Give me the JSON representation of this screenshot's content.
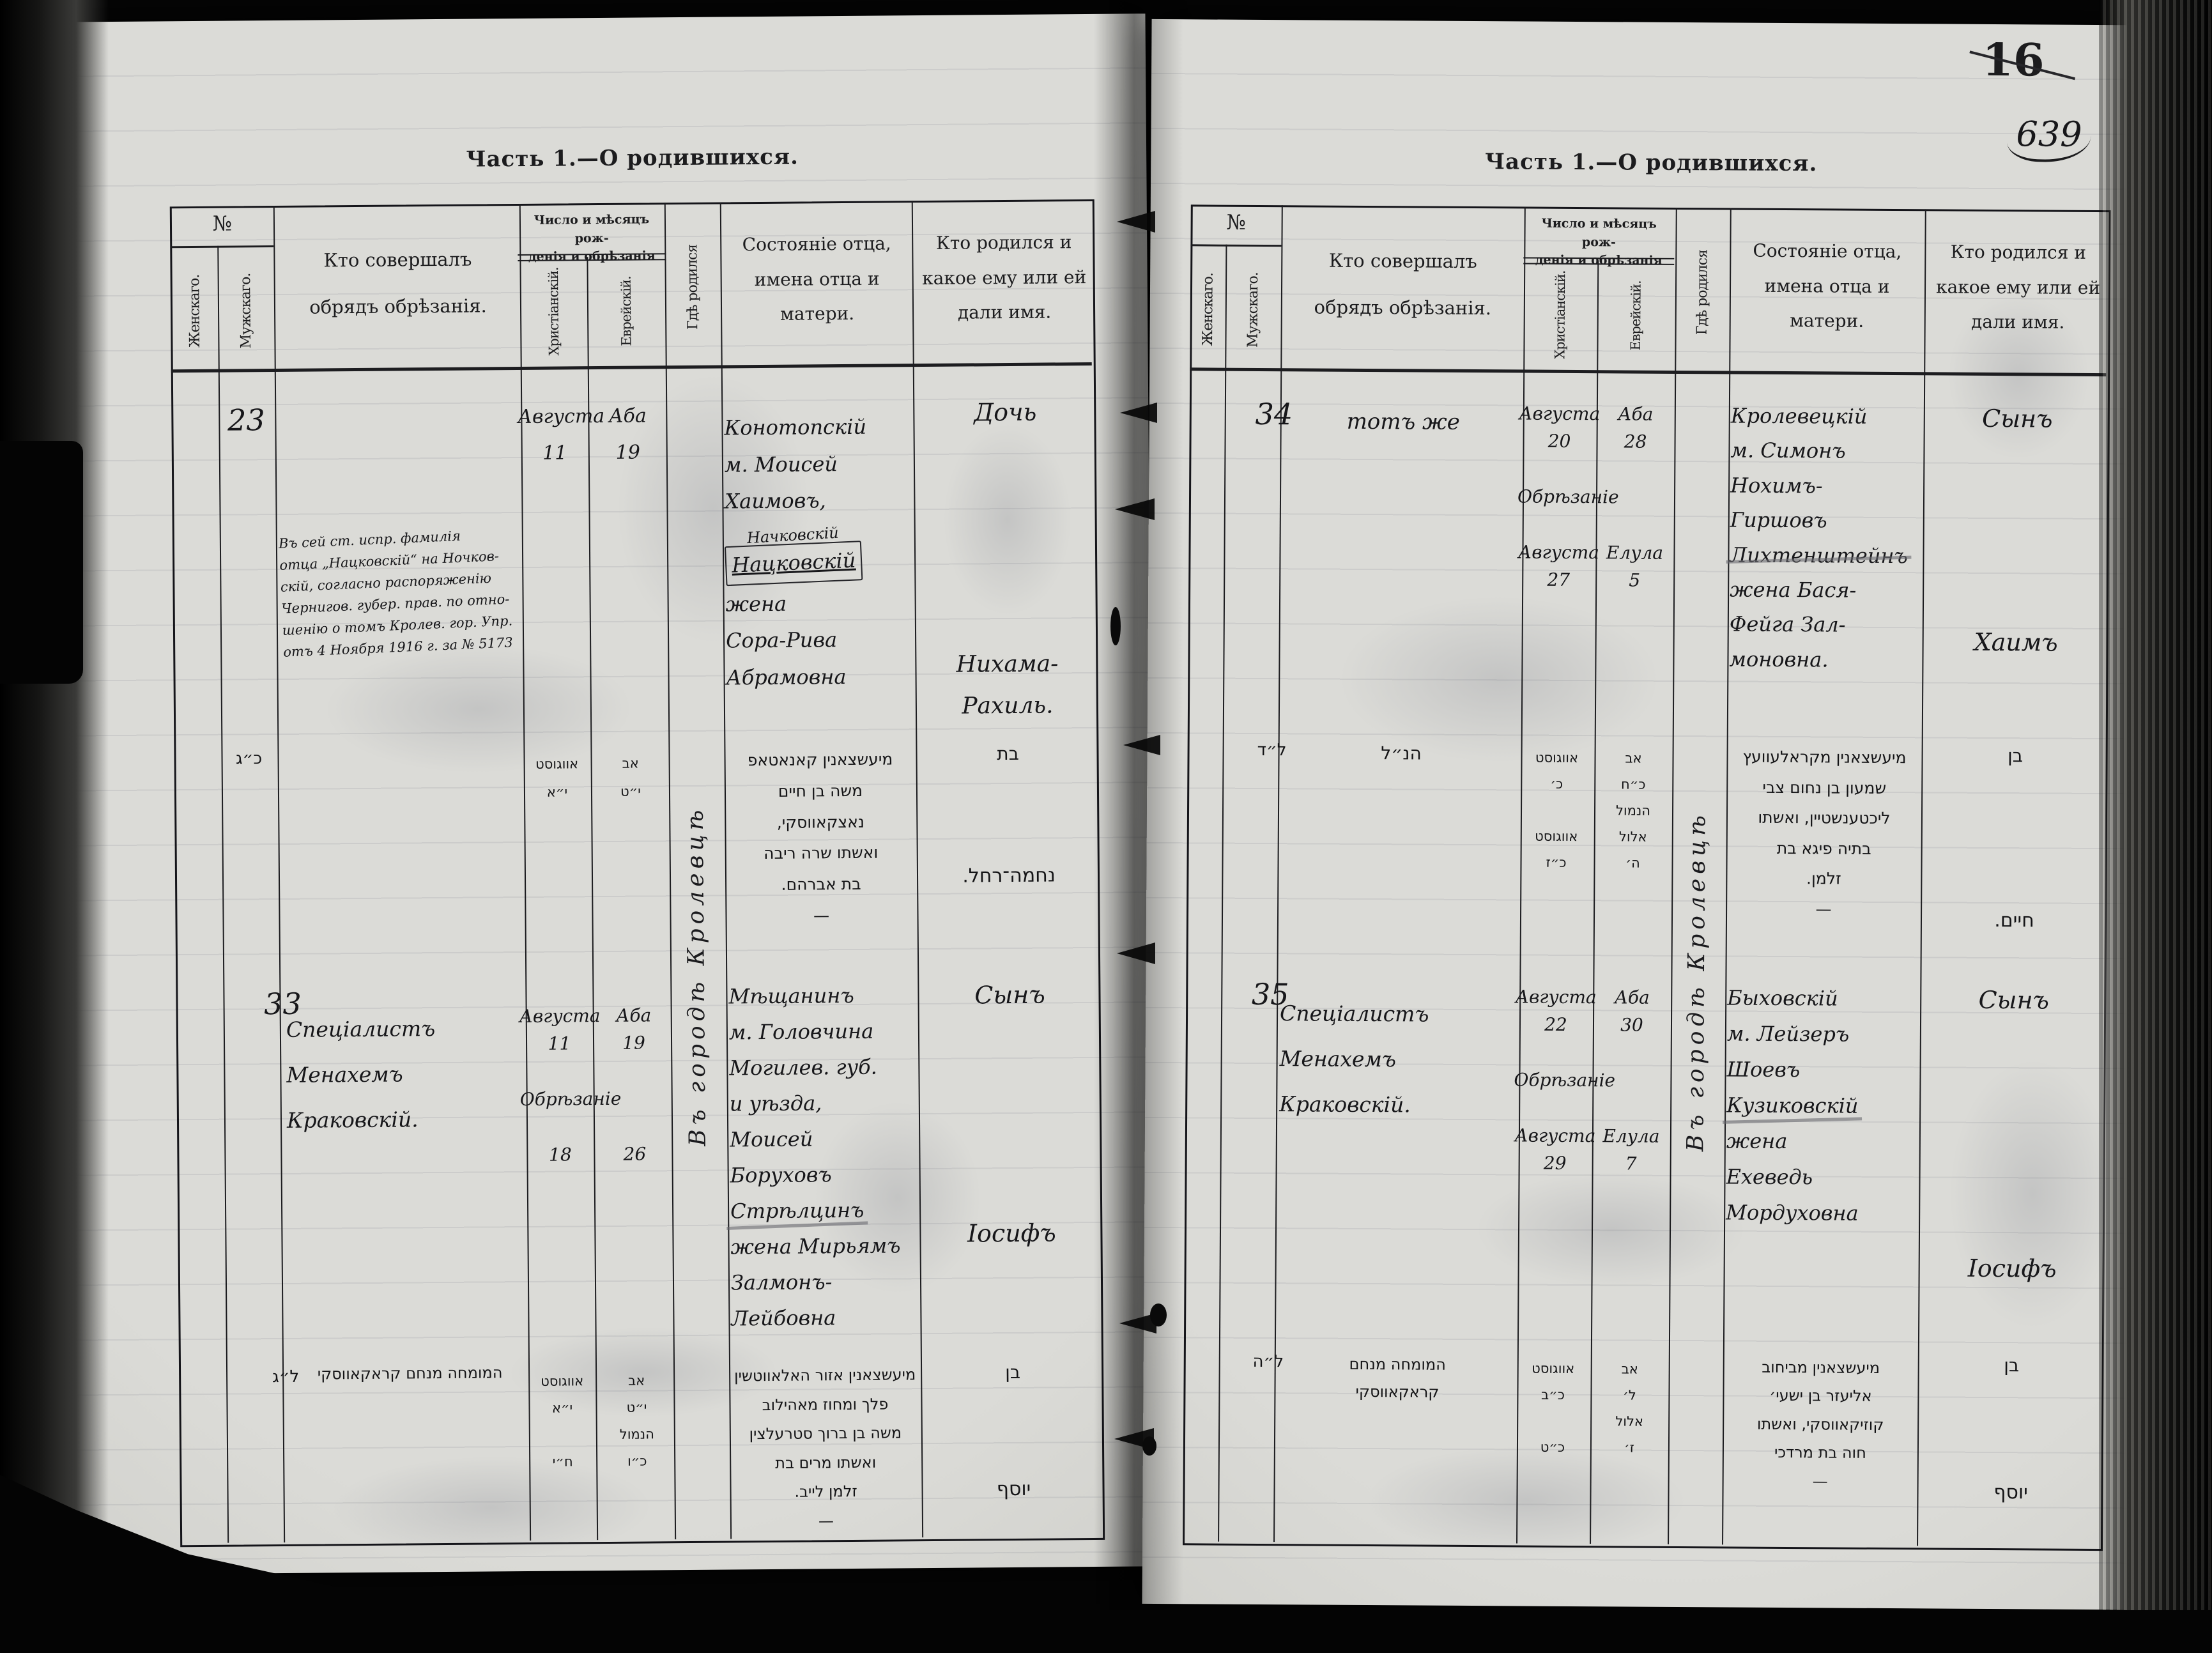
{
  "corner": {
    "printed_folio": "16",
    "handwritten_folio": "639"
  },
  "form": {
    "title": "Часть 1.—О родившихся.",
    "no": "№",
    "female": "Женскаго.",
    "male": "Мужскаго.",
    "officiant": "Кто совершалъ\nобрядъ обрѣзанія.",
    "dates": "Число и мѣсяцъ рож-\nденія и обрѣзанія",
    "christian": "Христіанскій.",
    "jewish": "Еврейскій.",
    "birthplace": "Гдѣ родился",
    "father": "Состояніе отца,\nимена отца и\nматери.",
    "child": "Кто родился и\nкакое ему или ей\nдали имя."
  },
  "left_page": {
    "birthplace_entry": "Въ городѣ Кролевцѣ",
    "record_23": {
      "number": "23",
      "annotation": "Въ сей ст. испр. фамилія\nотца „Нацковскій“ на Ночков-\nскій, согласно распоряженію\nЧернигов. губер. прав. по отно-\nшенію о томъ Кролев. гор. Упр.\nотъ 4 Ноября 1916 г. за № 5173",
      "date_christian": "Августа\n11",
      "date_jewish": "Аба\n19",
      "father_1": "Конотопскій\nм. Моисей\nХаимовъ,",
      "father_inserted": "Начковскій",
      "father_boxed": "Нацковскій",
      "father_2": "жена\nСора-Рива\nАбрамовна",
      "child_type": "Дочь",
      "child_name": "Нихама-\nРахиль."
    },
    "record_23_heb": {
      "number": "כ״ג",
      "date_christian": "אווגוסט\nי״א",
      "date_jewish": "אב\nי״ט",
      "father": "מיעשצאנין קאנאטאפ\nמשה בן חיים\nנאצקאווסקי,\nואשתו שרה ריבה\nבת אברהם.\n—",
      "child_type": "בת",
      "child_name": "נחמה־רחל."
    },
    "record_33": {
      "number": "33",
      "officiant": "Спеціалистъ\nМенахемъ\nКраковскій.",
      "date_christian": "Августа\n11\n\nОбрѣзаніе\n\n18",
      "date_jewish": "Аба\n19\n\n\n\n26",
      "father_1": "Мѣщанинъ\nм. Головчина\nМогилев. губ.\nи уѣзда,\nМоисей\nБоруховъ",
      "father_struck": "Стрѣлцинъ",
      "father_2": "жена Мирьямъ\nЗалмонъ-\nЛейбовна",
      "child_type": "Сынъ",
      "child_name": "Іосифъ"
    },
    "record_33_heb": {
      "number": "ל״ג",
      "officiant": "המומחה מנחם קראקאווסקי",
      "date_christian": "אווגוסט\nי״א\n\nח״י",
      "date_jewish": "אב\nי״ט\nהנמול\nכ״ו",
      "father": "מיעשצאנין אזור האלאווטשין\nפלך ומחוז מאהילוב\nמשה בן ברוך סטרעלצין\nואשתו מרים בת\nזלמן לייב.\n—",
      "child_type": "בן",
      "child_name": "יוסף"
    }
  },
  "right_page": {
    "birthplace_entry": "Въ городѣ Кролевцѣ",
    "record_34": {
      "number": "34",
      "officiant": "тотъ же",
      "date_christian": "Августа\n20\n\nОбрѣзаніе\n\nАвгуста\n27",
      "date_jewish": "Аба\n28\n\n\n\nЕлула\n5",
      "father_1": "Кролевецкій\nм. Симонъ\nНохимъ-\nГиршовъ",
      "father_struck": "Лихтенштейнъ",
      "father_2": "жена Бася-\nФейга Зал-\nмоновна.",
      "child_type": "Сынъ",
      "child_name": "Хаимъ"
    },
    "record_34_heb": {
      "number": "ל״ד",
      "officiant": "הנ״ל",
      "date_christian": "אווגוסט\nכ׳\n\nאווגוסט\nכ״ז",
      "date_jewish": "אב\nכ״ח\nהנמול\nאלול\nה׳",
      "father": "מיעשצאנין מקראלעוועץ\nשמעון בן נחום צבי\nליכטענשטיין, ואשתו\nבתיה פיגא בת\nזלמן.\n—",
      "child_type": "בן",
      "child_name": "חיים."
    },
    "record_35": {
      "number": "35",
      "officiant": "Спеціалистъ\nМенахемъ\nКраковскій.",
      "date_christian": "Августа\n22\n\nОбрѣзаніе\n\nАвгуста\n29",
      "date_jewish": "Аба\n30\n\n\n\nЕлула\n7",
      "father_1": "Быховскій\nм. Лейзеръ\nШоевъ",
      "father_struck": "Кузиковскій",
      "father_2": "жена\nЕхеведь\nМордуховна",
      "child_type": "Сынъ",
      "child_name": "Іосифъ"
    },
    "record_35_heb": {
      "number": "ל״ה",
      "officiant": "המומחה מנחם\nקראקאווסקי",
      "date_christian": "אווגוסט\nכ״ב\n\nכ״ט",
      "date_jewish": "אב\nל׳\nאלול\nז׳",
      "father": "מיעשצאנין מביחוב\nאליעזר בן ישעי׳\nקוזיקאווסקי, ואשתו\nחוה בת מרדכי\n—",
      "child_type": "בן",
      "child_name": "יוסף"
    }
  }
}
